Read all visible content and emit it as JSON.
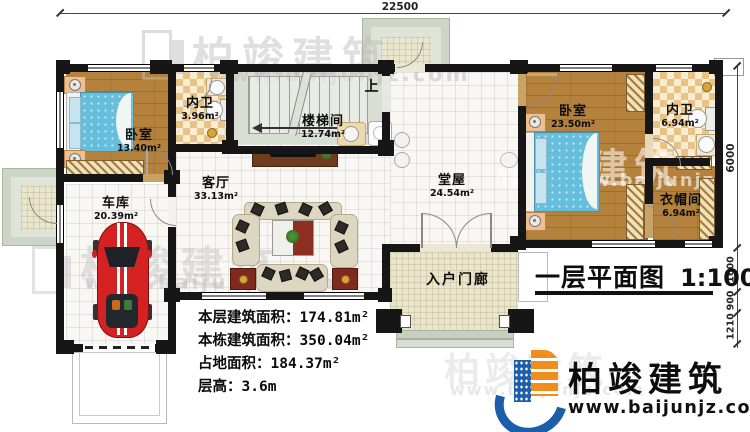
{
  "title": {
    "main": "一层平面图",
    "scale": "1:100"
  },
  "brand": {
    "name": "柏竣建筑",
    "url": "www.baijunjz.com"
  },
  "watermark": {
    "name": "柏竣建筑",
    "url": "www.baijunjz.com"
  },
  "dims": {
    "top": "22500",
    "right": [
      "6000",
      "1600",
      "900",
      "1210"
    ]
  },
  "annotations": {
    "up": "上"
  },
  "rooms": {
    "bedroom1": {
      "name": "卧室",
      "area": "13.40m²"
    },
    "bath1": {
      "name": "内卫",
      "area": "3.96m²"
    },
    "stairwell": {
      "name": "楼梯间",
      "area": "12.74m²"
    },
    "living": {
      "name": "客厅",
      "area": "33.13m²"
    },
    "hall": {
      "name": "堂屋",
      "area": "24.54m²"
    },
    "garage": {
      "name": "车库",
      "area": "20.39m²"
    },
    "bedroom2": {
      "name": "卧室",
      "area": "23.50m²"
    },
    "bath2": {
      "name": "内卫",
      "area": "6.94m²"
    },
    "cloakroom": {
      "name": "衣帽间",
      "area": "6.94m²"
    },
    "porch": {
      "name": "入户门廊"
    }
  },
  "info": [
    {
      "label": "本层建筑面积：",
      "value": "174.81m²"
    },
    {
      "label": "本栋建筑面积：",
      "value": "350.04m²"
    },
    {
      "label": "占地面积：",
      "value": "184.37m²"
    },
    {
      "label": "层高：",
      "value": "3.6m"
    }
  ],
  "colors": {
    "wall": "#161616",
    "wood": "#b5823e",
    "bed": "#66bedd",
    "car": "#d42222",
    "brand_blue": "#1c5fa8",
    "brand_orange": "#f28c1e"
  }
}
